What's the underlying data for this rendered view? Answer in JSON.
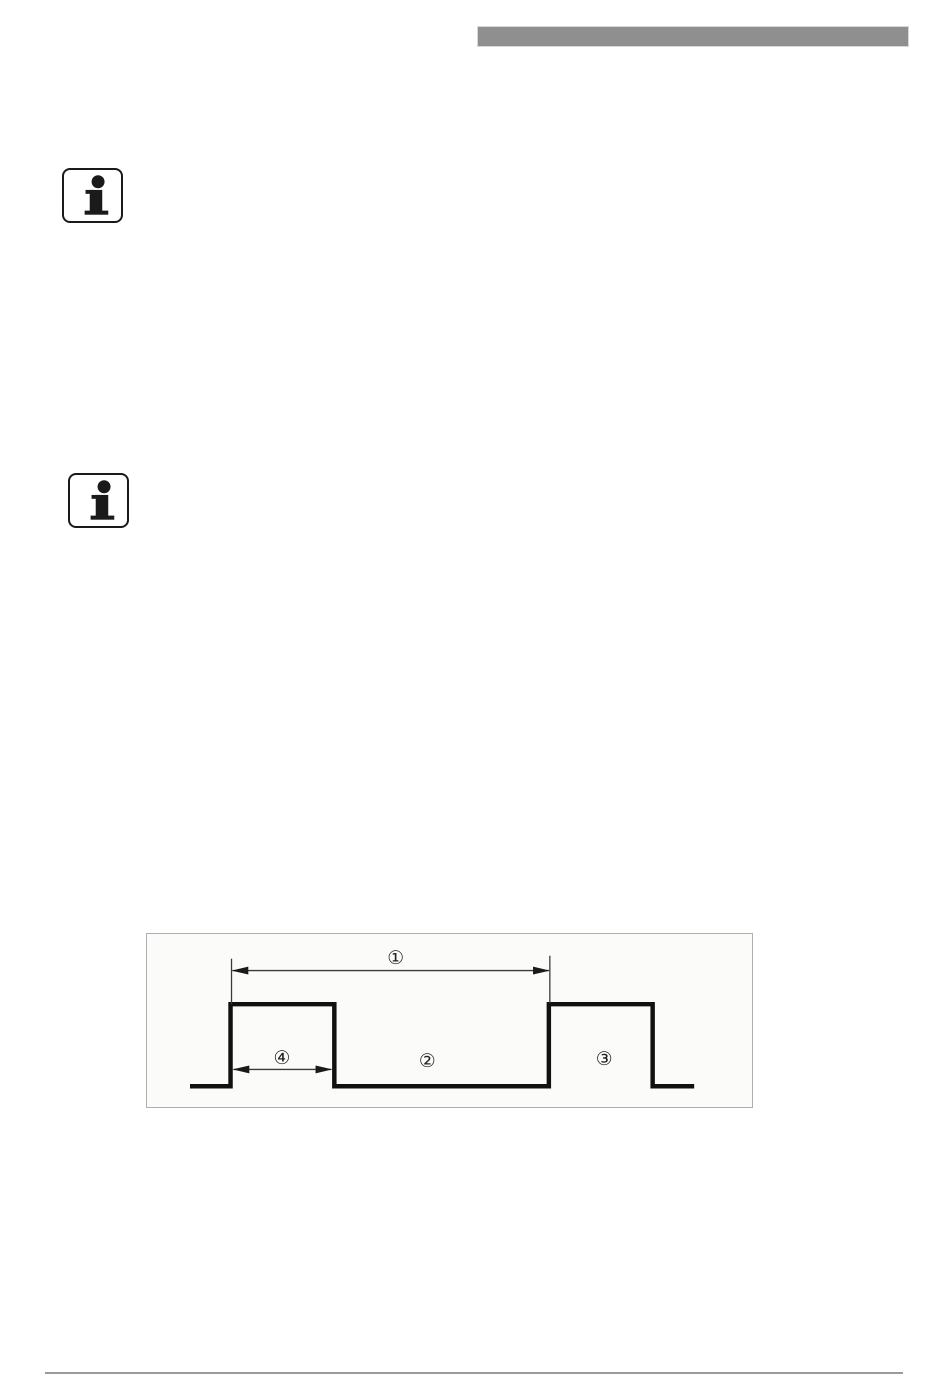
{
  "page": {
    "background_color": "#ffffff",
    "kind": "manual-page"
  },
  "header": {
    "redaction_bar_color": "#8f8f8f"
  },
  "notes": [
    {
      "icon": "info-icon"
    },
    {
      "icon": "info-icon"
    }
  ],
  "figure": {
    "type": "pulse-timing-diagram",
    "background_color": "#fbfbf9",
    "border_color": "#aeaeae",
    "waveform_color": "#111111",
    "dimension_color": "#3a3a3a",
    "labels": {
      "callout_1": "①",
      "callout_2": "②",
      "callout_3": "③",
      "callout_4": "④"
    }
  },
  "footer": {
    "divider_color": "#9b9b9b"
  }
}
